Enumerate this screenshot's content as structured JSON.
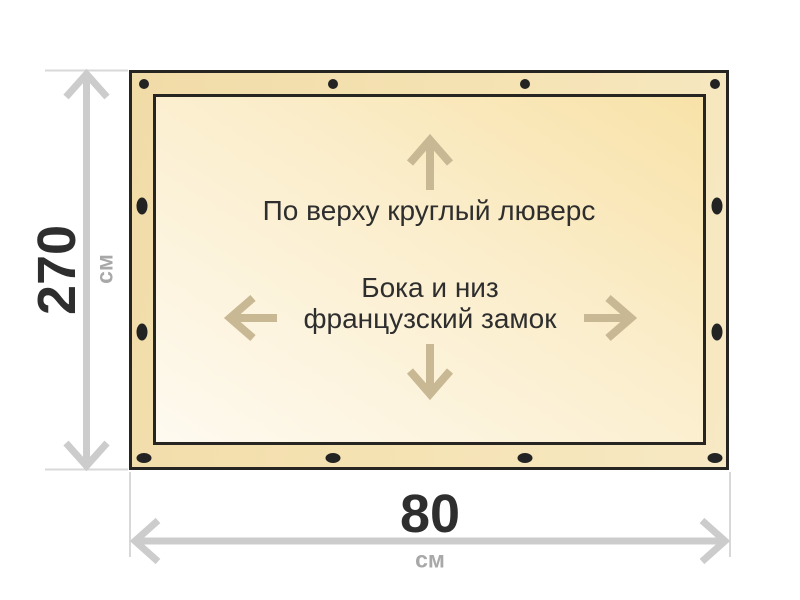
{
  "diagram": {
    "panel": {
      "annotations": {
        "top": "По верху круглый люверс",
        "center_line1": "Бока и низ",
        "center_line2": "французский замок"
      },
      "grommets": {
        "top": 4,
        "bottom": 4,
        "left": 2,
        "right": 2
      }
    },
    "dimensions": {
      "height": {
        "value": "270",
        "unit": "см"
      },
      "width": {
        "value": "80",
        "unit": "см"
      }
    },
    "icons": {
      "direction_arrows": [
        "arrow-up-icon",
        "arrow-left-icon",
        "arrow-right-icon",
        "arrow-down-icon"
      ],
      "grommet_dot": "filled-ellipse",
      "dimension_arrows": [
        "double-arrow-vertical-icon",
        "double-arrow-horizontal-icon"
      ]
    },
    "colors": {
      "background": "#ffffff",
      "panel_border": "#262522",
      "panel_band_dark": "#f1dca8",
      "panel_band_light": "#f7e9c4",
      "fabric_light": "#fefaf0",
      "fabric_dark": "#f8e2a8",
      "grommet": "#232323",
      "dimension_line": "#cccccc",
      "tick_line": "#d8d8d8",
      "value_text": "#2e2e2e",
      "unit_text": "#a8a8a8",
      "annotation_text": "#2e2e2e",
      "direction_arrow": "#c8b893"
    }
  }
}
